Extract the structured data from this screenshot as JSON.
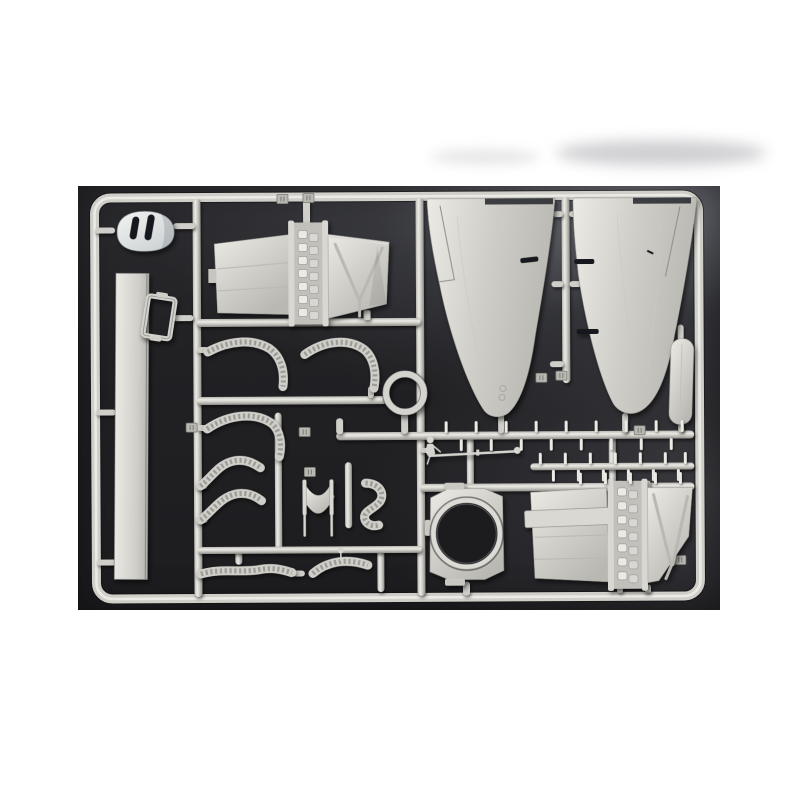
{
  "page": {
    "background": "#ffffff"
  },
  "photo": {
    "caption": "Light grey injection-molded sprue (parts tree) of aircraft model kit parts photographed on a dark charcoal background",
    "palette": {
      "page_bg": "#ffffff",
      "photo_bg": "#1d1d20",
      "plastic_light": "#eceae5",
      "plastic_base": "#cfcec8",
      "plastic_mid": "#b9b8b2",
      "plastic_shadow": "#8f8e89",
      "pearl_light": "#f2f4f2",
      "pearl_base": "#ccd1d2",
      "slot_dark": "#16181e",
      "hole_dark": "#1c1c1f"
    },
    "parts": [
      {
        "id": "engine-cowling",
        "label": "Engine cowling with two dark intake slots"
      },
      {
        "id": "spar-strip",
        "label": "Long flat spar strip"
      },
      {
        "id": "hatch-frame",
        "label": "Small open hatch frame"
      },
      {
        "id": "upper-flap-panel",
        "label": "Flap panel with hinge ladder and V-ribbed section"
      },
      {
        "id": "wing-half-left",
        "label": "Large tapered wing half (left)"
      },
      {
        "id": "wing-half-right",
        "label": "Large tapered wing half (right)"
      },
      {
        "id": "blade-panel",
        "label": "Small rounded blade panel"
      },
      {
        "id": "small-ring",
        "label": "Small circular ring"
      },
      {
        "id": "curved-strip-a",
        "label": "Curved treaded strip"
      },
      {
        "id": "curved-strip-b",
        "label": "Curved treaded strip"
      },
      {
        "id": "curved-strip-c",
        "label": "Curved treaded strip"
      },
      {
        "id": "s-duct-a",
        "label": "S-curved treaded duct"
      },
      {
        "id": "s-duct-b",
        "label": "S-curved treaded duct"
      },
      {
        "id": "pilot-figure",
        "label": "Tiny pilot figure"
      },
      {
        "id": "pitot-rod",
        "label": "Thin pitot/antenna rod"
      },
      {
        "id": "seat",
        "label": "Small bucket seat with legs"
      },
      {
        "id": "j-pipe",
        "label": "Hook-shaped treaded pipe"
      },
      {
        "id": "cowl-ring-plate",
        "label": "Plate with large circular cowl ring opening"
      },
      {
        "id": "lower-flap-panel",
        "label": "Flap panel with hinge ladder and V-ribbed section"
      },
      {
        "id": "tread-strip-a",
        "label": "Long treaded strip"
      },
      {
        "id": "tread-strip-b",
        "label": "Arched treaded strip"
      },
      {
        "id": "pin-row-a",
        "label": "Runner row of small pin parts"
      },
      {
        "id": "pin-row-b",
        "label": "Runner row of small pin parts"
      },
      {
        "id": "pin-row-c",
        "label": "Runner row of small pin parts"
      },
      {
        "id": "sprue-frame",
        "label": "Rounded rectangular sprue frame and runners"
      }
    ]
  }
}
